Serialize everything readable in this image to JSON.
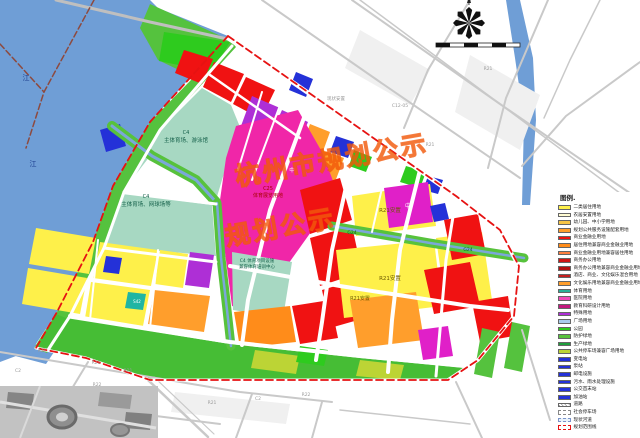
{
  "legend": {
    "title": "图例.",
    "items": [
      {
        "label": "二类居住用地",
        "color": "#fef04a",
        "type": "solid"
      },
      {
        "label": "农居安置用地",
        "color": "#fffbd2",
        "type": "solid"
      },
      {
        "label": "幼儿园、中小学用地",
        "color": "#f6c445",
        "type": "solid"
      },
      {
        "label": "规划公共服务设施配套用地",
        "color": "#ff9e2c",
        "type": "solid"
      },
      {
        "label": "商业金融业用地",
        "color": "#f01212",
        "type": "solid"
      },
      {
        "label": "居住用地兼容商业金融业用地",
        "color": "#ff8c1a",
        "type": "solid"
      },
      {
        "label": "商业金融业用地兼容居住用地",
        "color": "#ff7f3f",
        "type": "solid"
      },
      {
        "label": "商务办公用地",
        "color": "#d01616",
        "type": "solid"
      },
      {
        "label": "商务办公用地兼容商业金融业用地",
        "color": "#b31212",
        "type": "solid"
      },
      {
        "label": "酒店、商业、文化娱乐混合用地",
        "color": "#c51f1f",
        "type": "solid"
      },
      {
        "label": "文化娱乐用地兼容商业金融业用地",
        "color": "#ff9e2c",
        "type": "solid"
      },
      {
        "label": "体育用地",
        "color": "#2aaf97",
        "type": "solid"
      },
      {
        "label": "医院用地",
        "color": "#f148b8",
        "type": "solid"
      },
      {
        "label": "教育科研设计用地",
        "color": "#c2187e",
        "type": "solid"
      },
      {
        "label": "特殊用地",
        "color": "#ae2fd6",
        "type": "solid"
      },
      {
        "label": "广场用地",
        "color": "#a9cbec",
        "type": "solid"
      },
      {
        "label": "公园",
        "color": "#2ecb1e",
        "type": "solid"
      },
      {
        "label": "防护绿地",
        "color": "#57c23c",
        "type": "solid"
      },
      {
        "label": "生产绿地",
        "color": "#1e9e3c",
        "type": "solid"
      },
      {
        "label": "公共停车场兼容广场用地",
        "color": "#bcd435",
        "type": "solid"
      },
      {
        "label": "变电站",
        "color": "#2431d8",
        "type": "solid"
      },
      {
        "label": "泵站",
        "color": "#2431d8",
        "type": "solid"
      },
      {
        "label": "邮电设施",
        "color": "#2431d8",
        "type": "solid"
      },
      {
        "label": "污水、雨水处理设施",
        "color": "#2431d8",
        "type": "solid"
      },
      {
        "label": "公交首末站",
        "color": "#2431d8",
        "type": "solid"
      },
      {
        "label": "加油站",
        "color": "#2431d8",
        "type": "solid"
      },
      {
        "label": "道路",
        "color": "",
        "type": "hatch"
      },
      {
        "label": "社会停车场",
        "color": "",
        "type": "dash-grey"
      },
      {
        "label": "现状河道",
        "color": "",
        "type": "dash-blue"
      },
      {
        "label": "规划范围线",
        "color": "",
        "type": "dash-red"
      }
    ]
  },
  "watermark": [
    {
      "t": "杭州市规划公示",
      "x": 232,
      "y": 158,
      "size": 25
    },
    {
      "t": "规划公示",
      "x": 222,
      "y": 218,
      "size": 25
    }
  ],
  "map": {
    "zones": [
      {
        "n": "qiantang-river",
        "f": "#6f9ed6",
        "p": "0,0 150,0 158,8 228,36 150,122 113,186 93,242 57,312 32,350 0,362"
      },
      {
        "n": "river-sw",
        "f": "#6f9ed6",
        "p": "0,334 30,342 54,352 46,364 0,352"
      },
      {
        "n": "bank-top-green",
        "f": "#55c23e",
        "p": "150,4 234,42 204,82 158,60 140,28"
      },
      {
        "n": "bank-strip-green",
        "f": "#55c23e",
        "p": "230,40 150,122 113,186 93,242 57,312 34,348 47,353 69,318 103,250 123,194 159,131 236,47"
      },
      {
        "n": "park-top",
        "f": "#2ecb1e",
        "p": "164,32 230,42 212,72 159,61"
      },
      {
        "n": "commercial-a",
        "f": "#f01212",
        "p": "184,50 213,59 202,84 175,73"
      },
      {
        "n": "commercial-b",
        "f": "#f01212",
        "p": "214,62 244,74 231,102 203,87"
      },
      {
        "n": "commercial-c",
        "f": "#f01212",
        "p": "246,77 275,90 261,119 233,104"
      },
      {
        "n": "sports-natatorium",
        "f": "#a7d8c2",
        "p": "158,132 202,88 231,105 240,127 228,160 216,200 194,179 150,156 123,191"
      },
      {
        "n": "special-1",
        "f": "#ae2fd6",
        "p": "252,96 280,108 268,138 241,126"
      },
      {
        "n": "special-2",
        "f": "#ae2fd6",
        "p": "282,110 308,122 296,150 269,139"
      },
      {
        "n": "special-3",
        "f": "#ae2fd6",
        "p": "243,128 269,140 257,168 231,157"
      },
      {
        "n": "special-4",
        "f": "#ae2fd6",
        "p": "271,141 297,152 286,180 259,169"
      },
      {
        "n": "school-1",
        "f": "#e020c8",
        "p": "286,154 306,162 297,184 277,176"
      },
      {
        "n": "utility-ne",
        "f": "#2431d8",
        "p": "296,72 313,79 306,97 289,90"
      },
      {
        "n": "mixed-orange-1",
        "f": "#ff9e2c",
        "p": "310,124 330,132 322,154 302,146"
      },
      {
        "n": "mixed-orange-2",
        "f": "#ff9e2c",
        "p": "322,150 344,158 335,182 314,173"
      },
      {
        "n": "utility-mid",
        "f": "#2431d8",
        "p": "336,136 354,142 348,158 330,152"
      },
      {
        "n": "park-mid",
        "f": "#2ecb1e",
        "p": "354,150 372,157 366,172 349,166"
      },
      {
        "n": "park-ne",
        "f": "#2ecb1e",
        "p": "406,166 426,172 420,188 400,182"
      },
      {
        "n": "utility-ne2",
        "f": "#2431d8",
        "p": "428,176 443,180 438,194 423,190"
      },
      {
        "n": "expo-center-c25",
        "f": "#f026a8",
        "p": "236,126 298,110 322,152 338,194 254,312 232,306 219,207 226,158"
      },
      {
        "n": "sports-tennis",
        "f": "#a7d8c2",
        "p": "122,194 212,205 216,256 104,246"
      },
      {
        "n": "sports-training",
        "f": "#a7d8c2",
        "p": "232,252 292,262 283,318 233,310"
      },
      {
        "n": "special-5",
        "f": "#ae2fd6",
        "p": "190,252 214,255 209,288 185,285"
      },
      {
        "n": "residential-1",
        "f": "#fef04a",
        "p": "36,228 96,238 89,274 29,264"
      },
      {
        "n": "residential-2",
        "f": "#fef04a",
        "p": "100,242 158,250 151,286 93,278"
      },
      {
        "n": "residential-2b",
        "f": "#fef04a",
        "p": "160,250 188,254 183,288 155,284"
      },
      {
        "n": "residential-3",
        "f": "#fef04a",
        "p": "28,268 87,278 80,314 22,304"
      },
      {
        "n": "residential-4",
        "f": "#fef04a",
        "p": "91,282 150,290 143,326 85,318"
      },
      {
        "n": "mixed-orange-3",
        "f": "#ff9e2c",
        "p": "154,290 210,296 204,332 148,324"
      },
      {
        "n": "utility-w",
        "f": "#2431d8",
        "p": "106,256 122,258 119,274 103,272"
      },
      {
        "n": "parking-teal",
        "f": "#1fb5a3",
        "p": "128,292 146,294 143,310 125,308"
      },
      {
        "n": "commercial-c1",
        "f": "#f01212",
        "p": "300,190 340,178 352,220 310,234"
      },
      {
        "n": "commercial-c2",
        "f": "#f01212",
        "p": "310,238 352,226 362,272 320,286"
      },
      {
        "n": "commercial-c3",
        "f": "#f01212",
        "p": "322,290 362,278 372,316 330,328"
      },
      {
        "n": "resettlement-a",
        "f": "#fef04a",
        "p": "352,196 430,184 436,226 356,236"
      },
      {
        "n": "school-2",
        "f": "#e020c8",
        "p": "384,188 428,182 433,222 389,228"
      },
      {
        "n": "utility-e",
        "f": "#2431d8",
        "p": "430,206 445,203 449,219 434,222"
      },
      {
        "n": "resettlement-b",
        "f": "#fef04a",
        "p": "336,250 434,240 442,306 344,318"
      },
      {
        "n": "resettlement-c",
        "f": "#fef04a",
        "p": "436,238 482,232 492,300 446,308"
      },
      {
        "n": "commercial-e1",
        "f": "#f01212",
        "p": "444,220 478,214 486,254 452,260"
      },
      {
        "n": "commercial-e2",
        "f": "#f01212",
        "p": "424,270 470,262 480,306 434,314"
      },
      {
        "n": "commercial-e3",
        "f": "#f01212",
        "p": "472,302 508,296 514,336 480,342"
      },
      {
        "n": "mixed-orange-4",
        "f": "#ff9e2c",
        "p": "350,300 416,292 424,340 358,348"
      },
      {
        "n": "school-3",
        "f": "#e020c8",
        "p": "418,330 448,326 453,356 423,360"
      },
      {
        "n": "mixed-orange-5",
        "f": "#ff8c1a",
        "p": "234,312 290,306 296,342 240,348"
      },
      {
        "n": "commercial-s",
        "f": "#f01212",
        "p": "292,306 330,300 338,338 300,344"
      },
      {
        "n": "protective-strip",
        "f": "#46bd35",
        "p": "66,318 230,344 360,358 464,368 448,380 150,380 86,358 36,348 56,314"
      },
      {
        "n": "parking-green-1",
        "f": "#bcd435",
        "p": "255,350 300,356 296,374 251,368"
      },
      {
        "n": "parking-green-2",
        "f": "#bcd435",
        "p": "360,360 404,365 400,380 356,376"
      },
      {
        "n": "park-s",
        "f": "#2ecb1e",
        "p": "300,346 328,350 324,366 296,362"
      },
      {
        "n": "green-se1",
        "f": "#55c23e",
        "p": "482,328 500,332 492,378 474,374"
      },
      {
        "n": "green-se2",
        "f": "#55c23e",
        "p": "512,322 530,326 522,372 504,368"
      },
      {
        "n": "river-ne",
        "f": "#6f9ed6",
        "p": "506,0 520,0 533,58 536,120 530,205 522,205 524,120 515,58"
      },
      {
        "n": "city-block-1",
        "f": "#f0f0f0",
        "p": "470,55 540,95 520,150 455,112"
      },
      {
        "n": "city-block-2",
        "f": "#f0f0f0",
        "p": "360,30 430,70 410,105 345,68"
      },
      {
        "n": "city-block-3",
        "f": "#f0f0f0",
        "p": "175,392 290,404 286,424 171,412"
      },
      {
        "n": "utility-bank",
        "f": "#2431d8",
        "p": "100,130 120,124 126,146 106,152"
      }
    ],
    "roads": [
      {
        "n": "bridge-road",
        "p": "56,0 150,22 232,40",
        "c": "#bfbfbf",
        "w": 3
      },
      {
        "n": "road-grey",
        "p": "262,0 380,82 520,178",
        "c": "#c9c9c9",
        "w": 2
      },
      {
        "n": "expressway",
        "p": "352,0 500,104 640,200",
        "c": "#c9c9c9",
        "w": 2
      },
      {
        "n": "expressway-2",
        "p": "360,0 508,110 640,208",
        "c": "#c9c9c9",
        "w": 1.5
      },
      {
        "n": "road-grey",
        "p": "470,0 428,70 404,128",
        "c": "#c9c9c9",
        "w": 2
      },
      {
        "n": "road-grey",
        "p": "548,0 506,98 488,168",
        "c": "#c9c9c9",
        "w": 2
      },
      {
        "n": "road-grey",
        "p": "640,62 566,116 522,166",
        "c": "#c9c9c9",
        "w": 2
      },
      {
        "n": "road-grey",
        "p": "600,0 570,60 544,118",
        "c": "#c9c9c9",
        "w": 1.5
      },
      {
        "n": "road-grey",
        "p": "0,352 120,372 240,392 332,402",
        "c": "#c9c9c9",
        "w": 2
      },
      {
        "n": "road-grey",
        "p": "0,396 140,414 220,424",
        "c": "#c9c9c9",
        "w": 2
      },
      {
        "n": "road-grey",
        "p": "88,362 42,438",
        "c": "#c9c9c9",
        "w": 2
      },
      {
        "n": "arterial-sw",
        "p": "148,380 208,437",
        "c": "#c9c9c9",
        "w": 2.5
      },
      {
        "n": "arterial-sw2",
        "p": "154,377 214,434",
        "c": "#c9c9c9",
        "w": 1.2
      },
      {
        "n": "road-grey",
        "p": "252,394 236,438",
        "c": "#c9c9c9",
        "w": 2
      },
      {
        "n": "road-grey",
        "p": "322,402 312,438",
        "c": "#c9c9c9",
        "w": 2
      },
      {
        "n": "road-grey",
        "p": "456,382 482,438",
        "c": "#c9c9c9",
        "w": 2
      },
      {
        "n": "road-grey",
        "p": "522,330 550,420",
        "c": "#c9c9c9",
        "w": 2
      },
      {
        "n": "road-grey",
        "p": "340,410 470,424",
        "c": "#c9c9c9",
        "w": 1.5
      },
      {
        "n": "canal-band",
        "p": "112,126 152,156 196,180 216,202",
        "c": "#57c23c",
        "w": 10
      },
      {
        "n": "canal",
        "p": "112,126 152,156 196,180 216,202",
        "c": "#7ba7d9",
        "w": 3
      },
      {
        "n": "canal-band",
        "p": "217,203 221,258 227,310 231,346",
        "c": "#57c23c",
        "w": 9
      },
      {
        "n": "canal",
        "p": "217,203 221,258 227,310 231,346",
        "c": "#7ba7d9",
        "w": 2.5
      },
      {
        "n": "canal-band-g24",
        "p": "332,226 430,243 524,258",
        "c": "#57c23c",
        "w": 9
      },
      {
        "n": "canal",
        "p": "332,226 430,243 524,258",
        "c": "#7ba7d9",
        "w": 2.5
      },
      {
        "n": "riverside-road",
        "p": "232,46 160,130 124,192 104,248 70,316 48,350",
        "c": "#ffffff",
        "w": 3
      },
      {
        "n": "boundary-road-n",
        "p": "228,38 342,116 456,196",
        "c": "#ffffff",
        "w": 4.5
      },
      {
        "n": "boundary-road-e",
        "p": "456,196 500,230 518,266 514,316 478,360 448,380",
        "c": "#ffffff",
        "w": 3.5
      },
      {
        "n": "boundary-road-s",
        "p": "448,380 150,380 86,358 36,348",
        "c": "#ffffff",
        "w": 3
      },
      {
        "n": "cross-road-1",
        "p": "305,115 270,210 248,300 242,345",
        "c": "#ffffff",
        "w": 4
      },
      {
        "n": "cross-road-2",
        "p": "348,178 332,250 322,322 316,360",
        "c": "#ffffff",
        "w": 4
      },
      {
        "n": "cross-road-3",
        "p": "420,170 400,250 392,320 388,372",
        "c": "#ffffff",
        "w": 4
      },
      {
        "n": "cross-road-4",
        "p": "456,198 446,260 440,330 436,376",
        "c": "#ffffff",
        "w": 3
      },
      {
        "n": "cross-road-5",
        "p": "124,192 216,204",
        "c": "#ffffff",
        "w": 3
      },
      {
        "n": "cross-road-6",
        "p": "104,248 216,262",
        "c": "#ffffff",
        "w": 3
      },
      {
        "n": "arterial-mid",
        "p": "230,266 340,286 470,306 508,310",
        "c": "#ffffff",
        "w": 4
      },
      {
        "n": "arterial-s",
        "p": "70,316 230,342 360,356 466,366",
        "c": "#ffffff",
        "w": 4
      },
      {
        "n": "local-road",
        "p": "210,75 300,138",
        "c": "#ffffff",
        "w": 2.5
      },
      {
        "n": "local-road",
        "p": "262,92 238,170",
        "c": "#ffffff",
        "w": 2
      },
      {
        "n": "local-road",
        "p": "282,100 252,180",
        "c": "#ffffff",
        "w": 2
      },
      {
        "n": "local-road",
        "p": "382,188 372,232",
        "c": "#ffffff",
        "w": 2
      },
      {
        "n": "local-road",
        "p": "98,240 90,320",
        "c": "#ffffff",
        "w": 2
      },
      {
        "n": "local-road",
        "p": "158,250 150,328",
        "c": "#ffffff",
        "w": 2
      },
      {
        "n": "admin-boundary",
        "p": "94,0 44,92 26,148",
        "c": "#8d4a3f",
        "w": 1.5,
        "d": "6,3"
      },
      {
        "n": "admin-boundary",
        "p": "0,44 44,92",
        "c": "#8d4a3f",
        "w": 1.5,
        "d": "6,3"
      }
    ],
    "boundary": {
      "n": "planning-boundary",
      "p": "228,36 342,116 456,196 500,230 519,266 514,316 478,360 448,380 150,380 86,358 36,348 57,312 93,242 113,186 150,122 228,36",
      "c": "#e61212",
      "w": 1.8,
      "d": "7,4"
    },
    "labels": [
      {
        "t": "C4",
        "x": 186,
        "y": 134,
        "s": 5,
        "c": "#15604a"
      },
      {
        "t": "主体育场、游泳馆",
        "x": 186,
        "y": 142,
        "s": 5.5,
        "c": "#15604a"
      },
      {
        "t": "C4",
        "x": 146,
        "y": 198,
        "s": 5,
        "c": "#15604a"
      },
      {
        "t": "主体育场、网球场等",
        "x": 146,
        "y": 206,
        "s": 5.5,
        "c": "#15604a"
      },
      {
        "t": "C4 体育项目设施",
        "x": 257,
        "y": 262,
        "s": 4.5,
        "c": "#15604a"
      },
      {
        "t": "兼容体育培训中心",
        "x": 257,
        "y": 268,
        "s": 4.5,
        "c": "#15604a"
      },
      {
        "t": "C25",
        "x": 268,
        "y": 190,
        "s": 5,
        "c": "#a80000"
      },
      {
        "t": "体育展览用地",
        "x": 268,
        "y": 197,
        "s": 5,
        "c": "#a80000"
      },
      {
        "t": "R21安置",
        "x": 390,
        "y": 212,
        "s": 5.5,
        "c": "#6b5800"
      },
      {
        "t": "R21安置",
        "x": 390,
        "y": 280,
        "s": 5.5,
        "c": "#6b5800"
      },
      {
        "t": "R21安置",
        "x": 360,
        "y": 300,
        "s": 5,
        "c": "#6b5800"
      },
      {
        "t": "G24",
        "x": 352,
        "y": 234,
        "s": 4.5,
        "c": "#0b5c20"
      },
      {
        "t": "G24",
        "x": 468,
        "y": 251,
        "s": 4.5,
        "c": "#0b5c20"
      },
      {
        "t": "中",
        "x": 292,
        "y": 172,
        "s": 5.5,
        "c": "#ffffff"
      },
      {
        "t": "中",
        "x": 408,
        "y": 208,
        "s": 6,
        "c": "#ffffff"
      },
      {
        "t": "S42",
        "x": 137,
        "y": 303,
        "s": 4,
        "c": "#ffffff"
      },
      {
        "t": "江",
        "x": 26,
        "y": 80,
        "s": 7,
        "c": "#1d3f8f"
      },
      {
        "t": "江",
        "x": 33,
        "y": 166,
        "s": 7,
        "c": "#1d3f8f"
      },
      {
        "t": "现状安置",
        "x": 336,
        "y": 100,
        "s": 4.5,
        "c": "#9a9a9a"
      },
      {
        "t": "C12-05",
        "x": 400,
        "y": 107,
        "s": 4.5,
        "c": "#9a9a9a"
      },
      {
        "t": "R21",
        "x": 430,
        "y": 146,
        "s": 4.5,
        "c": "#9a9a9a"
      },
      {
        "t": "R21",
        "x": 488,
        "y": 70,
        "s": 4.5,
        "c": "#9a9a9a"
      },
      {
        "t": "R21",
        "x": 42,
        "y": 352,
        "s": 4.5,
        "c": "#9a9a9a"
      },
      {
        "t": "C2",
        "x": 18,
        "y": 372,
        "s": 4.5,
        "c": "#9a9a9a"
      },
      {
        "t": "R21",
        "x": 96,
        "y": 364,
        "s": 4.5,
        "c": "#9a9a9a"
      },
      {
        "t": "R22",
        "x": 97,
        "y": 386,
        "s": 4.5,
        "c": "#9a9a9a"
      },
      {
        "t": "R21",
        "x": 128,
        "y": 372,
        "s": 4.5,
        "c": "#9a9a9a"
      },
      {
        "t": "R21",
        "x": 212,
        "y": 404,
        "s": 4.5,
        "c": "#9a9a9a"
      },
      {
        "t": "C2",
        "x": 258,
        "y": 400,
        "s": 4.5,
        "c": "#9a9a9a"
      },
      {
        "t": "R22",
        "x": 306,
        "y": 396,
        "s": 4.5,
        "c": "#9a9a9a"
      }
    ]
  }
}
